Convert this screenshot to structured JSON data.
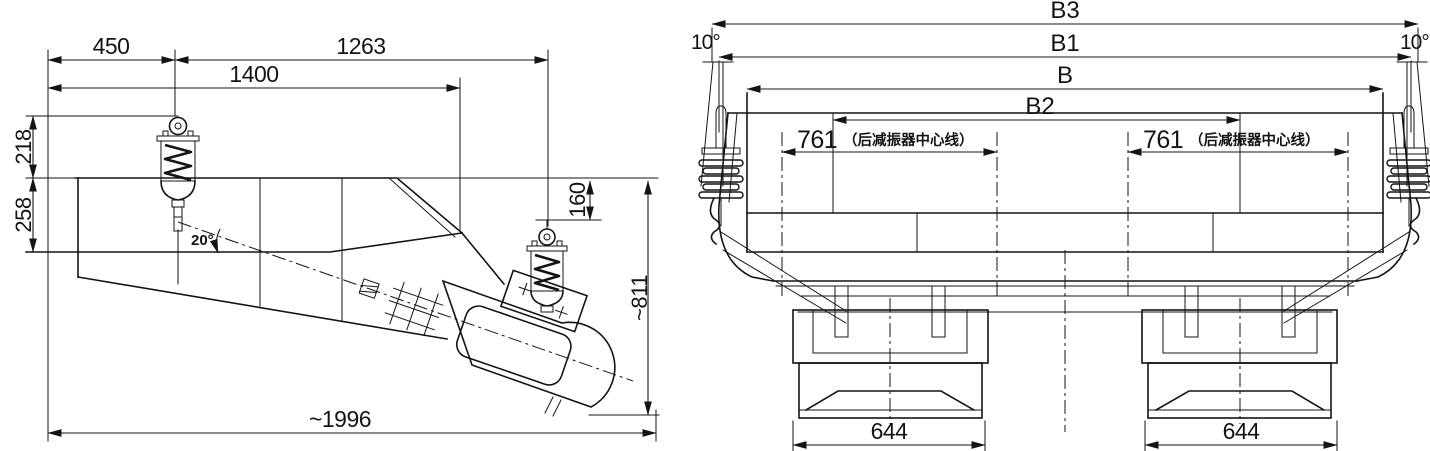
{
  "drawing": {
    "colors": {
      "line": "#141414",
      "background": "#ffffff"
    },
    "side_view": {
      "title": "feeder side elevation",
      "dims": {
        "d450": "450",
        "d1263": "1263",
        "d1400": "1400",
        "d218": "218",
        "d258": "258",
        "d160": "160",
        "d811": "~811",
        "d1996": "~1996",
        "angle20": "20°"
      }
    },
    "end_view": {
      "title": "feeder end elevation",
      "dims": {
        "b3": "B3",
        "b1": "B1",
        "b": "B",
        "b2": "B2",
        "tilt_left": "10°",
        "tilt_right": "10°",
        "damper_left_value": "761",
        "damper_left_note": "（后减振器中心线）",
        "damper_right_value": "761",
        "damper_right_note": "（后减振器中心线）",
        "base_left": "644",
        "base_right": "644"
      }
    }
  }
}
